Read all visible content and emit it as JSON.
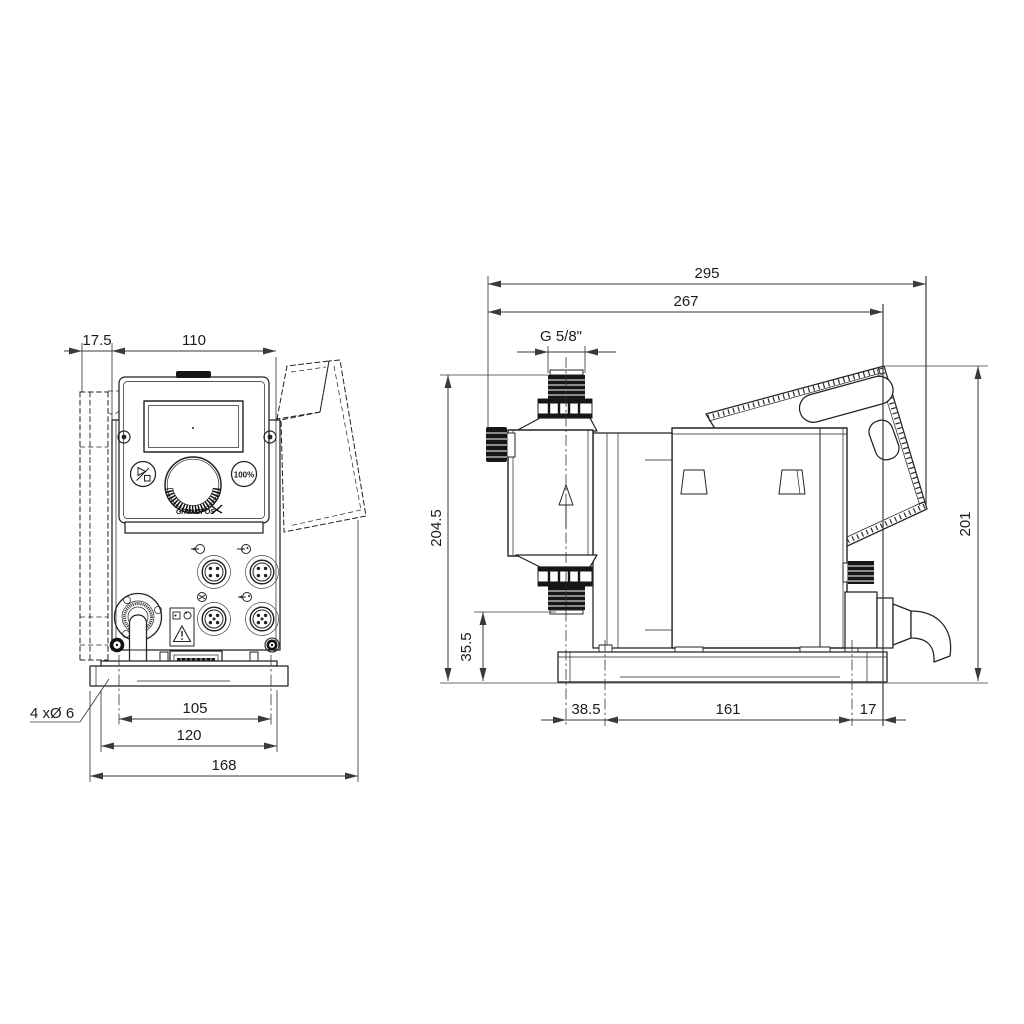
{
  "front": {
    "dim_wall_depth": "17.5",
    "dim_width": "110",
    "dim_slot_spacing": "105",
    "dim_plate_width": "120",
    "dim_overall_width": "168",
    "note_mounting_holes": "4 xØ 6",
    "button_percent": "100%",
    "brand": "GRUNDFOS"
  },
  "side": {
    "dim_overall_depth": "295",
    "dim_depth_to_cable_gland": "267",
    "dim_thread": "G 5/8\"",
    "dim_height_discharge": "204.5",
    "dim_suction_height": "35.5",
    "dim_center_to_slot": "38.5",
    "dim_slot_spacing": "161",
    "dim_slot_to_gland": "17",
    "dim_overall_height": "201"
  }
}
